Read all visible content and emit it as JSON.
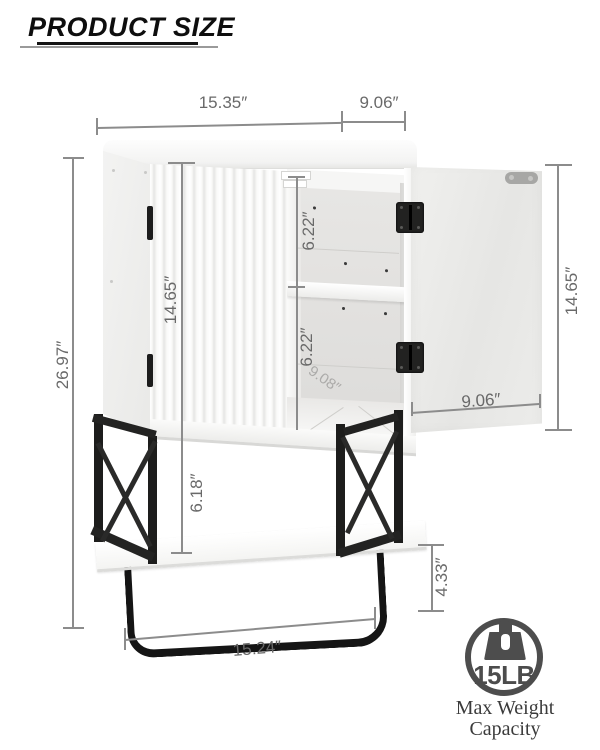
{
  "header": {
    "title": "PRODUCT SIZE"
  },
  "dimensions": {
    "top_width": "15.35″",
    "top_depth": "9.06″",
    "overall_height": "26.97″",
    "left_door_height": "14.65″",
    "upper_compartment_height": "6.22″",
    "lower_compartment_height": "6.22″",
    "right_door_height": "14.65″",
    "right_door_width": "9.06″",
    "open_shelf_height": "6.18″",
    "towel_bar_drop": "4.33″",
    "bottom_width": "15.24″",
    "interior_depth_faint": "9.08″"
  },
  "badge": {
    "capacity": "15LB",
    "caption_line1": "Max Weight",
    "caption_line2": "Capacity",
    "icon": "weight-icon"
  },
  "colors": {
    "dimension_line": "#8c8c8c",
    "dimension_text": "#696969",
    "metal_frame": "#1d1d1c",
    "badge_gray": "#4d4d4d",
    "cabinet_white": "#fcfcfc"
  }
}
